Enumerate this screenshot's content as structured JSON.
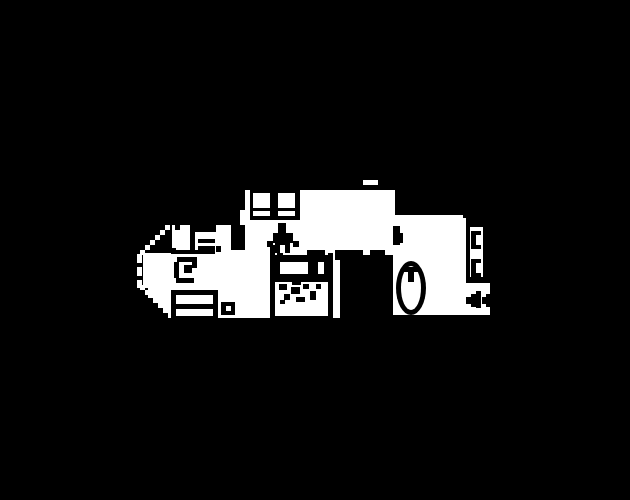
{
  "canvas": {
    "width": 630,
    "height": 500,
    "background": "#000000",
    "foreground": "#ffffff"
  },
  "plan": {
    "kind": "pixel-art-floorplan",
    "palette": {
      "wall_and_furniture": "#000000",
      "floor_and_fixtures": "#ffffff"
    },
    "layers": [
      {
        "color": "#ffffff",
        "rects": [
          [
            245,
            190,
            150,
            60
          ],
          [
            363,
            180,
            15,
            5
          ],
          [
            240,
            210,
            5,
            15
          ],
          [
            393,
            215,
            70,
            100
          ],
          [
            460,
            218,
            6,
            74
          ],
          [
            460,
            283,
            30,
            9
          ],
          [
            463,
            292,
            27,
            23
          ],
          [
            235,
            250,
            105,
            68
          ],
          [
            148,
            253,
            87,
            65
          ],
          [
            143,
            253,
            5,
            35
          ],
          [
            215,
            250,
            20,
            3
          ],
          [
            172,
            225,
            18,
            28
          ],
          [
            195,
            232,
            21,
            21
          ],
          [
            216,
            225,
            15,
            27
          ],
          [
            165,
            225,
            5,
            5
          ],
          [
            160,
            230,
            5,
            5
          ],
          [
            155,
            235,
            5,
            5
          ],
          [
            150,
            240,
            5,
            5
          ],
          [
            145,
            245,
            5,
            5
          ],
          [
            140,
            250,
            5,
            5
          ],
          [
            137,
            254,
            5,
            9
          ],
          [
            137,
            267,
            5,
            9
          ],
          [
            137,
            280,
            5,
            8
          ],
          [
            140,
            285,
            5,
            5
          ],
          [
            145,
            290,
            5,
            5
          ],
          [
            150,
            295,
            5,
            5
          ],
          [
            155,
            300,
            5,
            5
          ],
          [
            160,
            305,
            5,
            5
          ],
          [
            165,
            310,
            5,
            5
          ]
        ],
        "ellipses": []
      },
      {
        "color": "#000000",
        "rects": [
          [
            300,
            185,
            95,
            5
          ],
          [
            250,
            190,
            50,
            30
          ],
          [
            278,
            223,
            8,
            10
          ],
          [
            273,
            233,
            20,
            10
          ],
          [
            275,
            243,
            15,
            10
          ],
          [
            267,
            241,
            6,
            6
          ],
          [
            293,
            241,
            6,
            6
          ],
          [
            175,
            225,
            5,
            5
          ],
          [
            172,
            248,
            4,
            5
          ],
          [
            198,
            239,
            17,
            4
          ],
          [
            198,
            246,
            17,
            4
          ],
          [
            216,
            246,
            5,
            6
          ],
          [
            171,
            250,
            44,
            4
          ],
          [
            177,
            257,
            20,
            5
          ],
          [
            192,
            262,
            5,
            6
          ],
          [
            184,
            265,
            8,
            8
          ],
          [
            174,
            262,
            5,
            16
          ],
          [
            176,
            278,
            18,
            5
          ],
          [
            171,
            290,
            47,
            28
          ],
          [
            221,
            302,
            14,
            13
          ],
          [
            148,
            298,
            5,
            20
          ],
          [
            153,
            303,
            5,
            15
          ],
          [
            158,
            308,
            5,
            10
          ],
          [
            163,
            313,
            5,
            5
          ],
          [
            270,
            245,
            5,
            75
          ],
          [
            277,
            250,
            6,
            5
          ],
          [
            307,
            250,
            18,
            5
          ],
          [
            335,
            250,
            5,
            10
          ],
          [
            295,
            256,
            20,
            3
          ],
          [
            275,
            255,
            53,
            5
          ],
          [
            275,
            260,
            53,
            16
          ],
          [
            328,
            253,
            5,
            65
          ],
          [
            275,
            276,
            53,
            6
          ],
          [
            301,
            272,
            10,
            6
          ],
          [
            292,
            281,
            9,
            4
          ],
          [
            279,
            284,
            8,
            6
          ],
          [
            291,
            287,
            9,
            7
          ],
          [
            303,
            284,
            6,
            5
          ],
          [
            316,
            284,
            5,
            5
          ],
          [
            284,
            294,
            6,
            6
          ],
          [
            296,
            297,
            9,
            5
          ],
          [
            310,
            291,
            6,
            9
          ],
          [
            280,
            300,
            5,
            4
          ],
          [
            270,
            316,
            63,
            4
          ],
          [
            340,
            250,
            53,
            70
          ],
          [
            393,
            226,
            7,
            19
          ],
          [
            398,
            233,
            5,
            10
          ],
          [
            466,
            222,
            24,
            60
          ],
          [
            466,
            297,
            5,
            7
          ],
          [
            471,
            294,
            5,
            13
          ],
          [
            476,
            291,
            5,
            17
          ],
          [
            482,
            297,
            4,
            7
          ],
          [
            486,
            294,
            4,
            13
          ]
        ],
        "ellipses": [
          [
            396,
            261,
            30,
            54
          ]
        ]
      },
      {
        "color": "#ffffff",
        "rects": [
          [
            253,
            193,
            17,
            15
          ],
          [
            278,
            193,
            17,
            15
          ],
          [
            253,
            211,
            17,
            5
          ],
          [
            278,
            211,
            17,
            5
          ],
          [
            280,
            245,
            5,
            8
          ],
          [
            363,
            250,
            7,
            5
          ],
          [
            385,
            250,
            8,
            5
          ],
          [
            280,
            262,
            28,
            12
          ],
          [
            318,
            262,
            6,
            12
          ],
          [
            176,
            295,
            37,
            9
          ],
          [
            176,
            309,
            37,
            7
          ],
          [
            226,
            306,
            5,
            5
          ],
          [
            470,
            227,
            13,
            50
          ]
        ],
        "ellipses": [
          [
            401,
            266,
            20,
            44
          ]
        ]
      },
      {
        "color": "#000000",
        "rects": [
          [
            404,
            267,
            14,
            5
          ],
          [
            408,
            272,
            6,
            10
          ],
          [
            471,
            231,
            10,
            4
          ],
          [
            471,
            235,
            5,
            10
          ],
          [
            471,
            245,
            10,
            4
          ],
          [
            471,
            259,
            10,
            4
          ],
          [
            471,
            263,
            5,
            10
          ],
          [
            471,
            273,
            10,
            4
          ]
        ],
        "ellipses": []
      }
    ]
  },
  "regions": {
    "main-room": {
      "x": 245,
      "y": 190,
      "w": 150,
      "h": 60
    },
    "front-dinette": {
      "x": 137,
      "y": 220,
      "w": 110,
      "h": 100
    },
    "dinette-table": {
      "x": 195,
      "y": 232,
      "w": 21,
      "h": 21
    },
    "sofa-berth": {
      "x": 250,
      "y": 190,
      "w": 50,
      "h": 30
    },
    "seat-figure": {
      "x": 267,
      "y": 222,
      "w": 32,
      "h": 31
    },
    "swivel-seat": {
      "x": 174,
      "y": 257,
      "w": 24,
      "h": 26
    },
    "bed": {
      "x": 171,
      "y": 290,
      "w": 47,
      "h": 28
    },
    "stool": {
      "x": 221,
      "y": 302,
      "w": 14,
      "h": 13
    },
    "kitchen-counter": {
      "x": 270,
      "y": 250,
      "w": 63,
      "h": 70
    },
    "sink": {
      "x": 276,
      "y": 281,
      "w": 50,
      "h": 26
    },
    "dark-doorway": {
      "x": 340,
      "y": 250,
      "w": 53,
      "h": 70
    },
    "bathroom": {
      "x": 393,
      "y": 215,
      "w": 70,
      "h": 100
    },
    "bathtub": {
      "x": 396,
      "y": 261,
      "w": 30,
      "h": 54
    },
    "wardrobe": {
      "x": 466,
      "y": 222,
      "w": 24,
      "h": 60
    },
    "entry-arrows": {
      "x": 466,
      "y": 291,
      "w": 24,
      "h": 18
    }
  }
}
